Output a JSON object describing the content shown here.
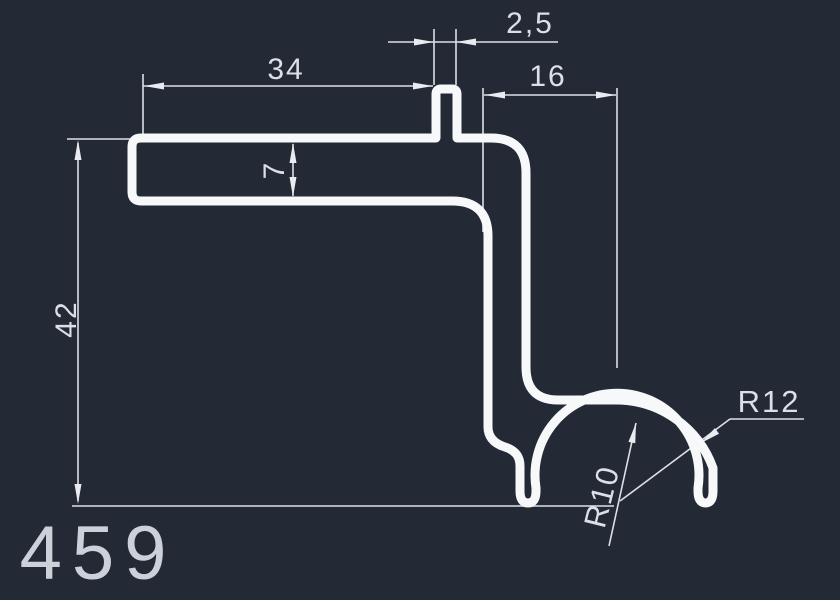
{
  "drawing": {
    "part_number": "459",
    "background_color": "#232935",
    "profile_stroke_color": "#f7f8f9",
    "dimension_color": "#dce0e6"
  },
  "dimensions": {
    "top_flange_width": "34",
    "tab_width": "2,5",
    "right_offset": "16",
    "flange_thickness": "7",
    "total_height": "42",
    "outer_radius": "R12",
    "inner_radius": "R10"
  }
}
